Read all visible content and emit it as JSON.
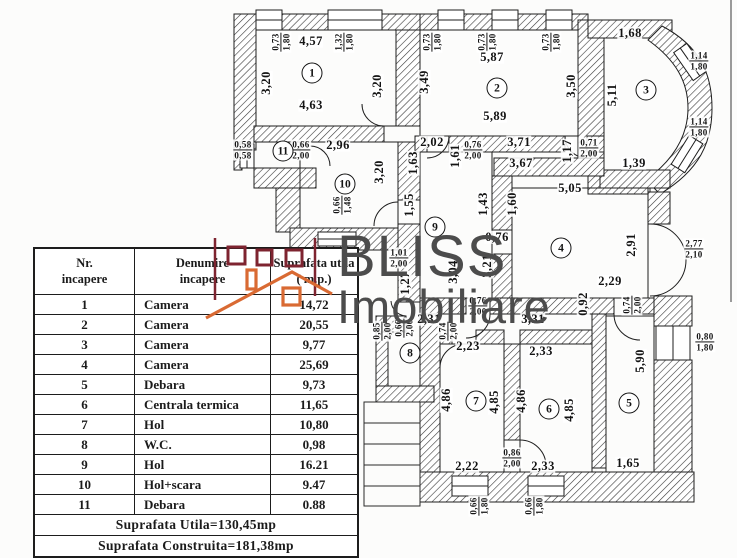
{
  "logo": {
    "line1": "BLISS",
    "line2": "Imobiliare"
  },
  "colors": {
    "brand_red": "#7e2430",
    "brand_orange": "#d96a33",
    "ink": "#1b1b1b",
    "logo_gray": "#4c4c4c"
  },
  "table": {
    "col1_header": "Nr.\nincapere",
    "col2_header": "Denumire\nincapere",
    "col3_header": "Suprafata utila\n( m.p.)",
    "rows": [
      {
        "nr": "1",
        "name": "Camera",
        "area": "14,72"
      },
      {
        "nr": "2",
        "name": "Camera",
        "area": "20,55"
      },
      {
        "nr": "3",
        "name": "Camera",
        "area": "9,77"
      },
      {
        "nr": "4",
        "name": "Camera",
        "area": "25,69"
      },
      {
        "nr": "5",
        "name": "Debara",
        "area": "9,73"
      },
      {
        "nr": "6",
        "name": "Centrala termica",
        "area": "11,65"
      },
      {
        "nr": "7",
        "name": "Hol",
        "area": "10,80"
      },
      {
        "nr": "8",
        "name": "W.C.",
        "area": "0,98"
      },
      {
        "nr": "9",
        "name": "Hol",
        "area": "16.21"
      },
      {
        "nr": "10",
        "name": "Hol+scara",
        "area": "9.47"
      },
      {
        "nr": "11",
        "name": "Debara",
        "area": "0.88"
      }
    ],
    "total_utila": "Suprafata Utila=130,45mp",
    "total_construita": "Suprafata Construita=181,38mp"
  },
  "plan": {
    "rooms": [
      {
        "n": "1",
        "x": 312,
        "y": 73
      },
      {
        "n": "2",
        "x": 497,
        "y": 88
      },
      {
        "n": "3",
        "x": 646,
        "y": 90
      },
      {
        "n": "4",
        "x": 561,
        "y": 248
      },
      {
        "n": "5",
        "x": 629,
        "y": 403
      },
      {
        "n": "6",
        "x": 549,
        "y": 409
      },
      {
        "n": "7",
        "x": 476,
        "y": 401
      },
      {
        "n": "8",
        "x": 410,
        "y": 353
      },
      {
        "n": "9",
        "x": 435,
        "y": 227
      },
      {
        "n": "10",
        "x": 345,
        "y": 184
      },
      {
        "n": "11",
        "x": 283,
        "y": 151
      }
    ],
    "labels": [
      {
        "t": "4,57",
        "x": 311,
        "y": 41
      },
      {
        "t": "0,73|1,80",
        "x": 281,
        "y": 42,
        "r": -90
      },
      {
        "t": "1,32|1,80",
        "x": 344,
        "y": 42,
        "r": -90
      },
      {
        "t": "3,20",
        "x": 266,
        "y": 83,
        "r": -90
      },
      {
        "t": "3,20",
        "x": 377,
        "y": 86,
        "r": -90
      },
      {
        "t": "4,63",
        "x": 311,
        "y": 105
      },
      {
        "t": "0,73|1,80",
        "x": 432,
        "y": 42,
        "r": -90
      },
      {
        "t": "0,73|1,80",
        "x": 487,
        "y": 42,
        "r": -90
      },
      {
        "t": "0,73|1,80",
        "x": 551,
        "y": 42,
        "r": -90
      },
      {
        "t": "5,87",
        "x": 492,
        "y": 57
      },
      {
        "t": "3,49",
        "x": 424,
        "y": 82,
        "r": -90
      },
      {
        "t": "3,50",
        "x": 571,
        "y": 86,
        "r": -90
      },
      {
        "t": "5,89",
        "x": 495,
        "y": 116
      },
      {
        "t": "1,68",
        "x": 630,
        "y": 33
      },
      {
        "t": "5,11",
        "x": 612,
        "y": 95,
        "r": -90
      },
      {
        "t": "1,14|1,80",
        "x": 699,
        "y": 61
      },
      {
        "t": "1,14|1,80",
        "x": 699,
        "y": 127
      },
      {
        "t": "1,39",
        "x": 634,
        "y": 163
      },
      {
        "t": "0,58|0,58",
        "x": 243,
        "y": 150
      },
      {
        "t": "0,66|2,00",
        "x": 301,
        "y": 150
      },
      {
        "t": "2,96",
        "x": 338,
        "y": 145
      },
      {
        "t": "3,20",
        "x": 379,
        "y": 172,
        "r": -90
      },
      {
        "t": "0,66|1,48",
        "x": 342,
        "y": 205,
        "r": -90
      },
      {
        "t": "1,63",
        "x": 413,
        "y": 163,
        "r": -90
      },
      {
        "t": "1,55",
        "x": 409,
        "y": 205,
        "r": -90
      },
      {
        "t": "2,02",
        "x": 432,
        "y": 142
      },
      {
        "t": "1,61",
        "x": 455,
        "y": 156,
        "r": -90
      },
      {
        "t": "0,76|2,00",
        "x": 473,
        "y": 150
      },
      {
        "t": "3,71",
        "x": 519,
        "y": 142
      },
      {
        "t": "3,67",
        "x": 521,
        "y": 163
      },
      {
        "t": "1,17",
        "x": 567,
        "y": 151,
        "r": -90
      },
      {
        "t": "0,71|2,00",
        "x": 589,
        "y": 148
      },
      {
        "t": "5,05",
        "x": 570,
        "y": 188
      },
      {
        "t": "1,43",
        "x": 483,
        "y": 204,
        "r": -90
      },
      {
        "t": "1,60",
        "x": 512,
        "y": 204,
        "r": -90
      },
      {
        "t": "0,76",
        "x": 497,
        "y": 237
      },
      {
        "t": "1,01|2,00",
        "x": 399,
        "y": 258
      },
      {
        "t": "1,27",
        "x": 405,
        "y": 283,
        "r": -90
      },
      {
        "t": "3,04",
        "x": 453,
        "y": 272,
        "r": -90
      },
      {
        "t": "3,21",
        "x": 487,
        "y": 266,
        "r": -90
      },
      {
        "t": "0,76|2,00",
        "x": 478,
        "y": 306
      },
      {
        "t": "2,91",
        "x": 631,
        "y": 245,
        "r": -90
      },
      {
        "t": "2,77|2,10",
        "x": 694,
        "y": 249
      },
      {
        "t": "2,29",
        "x": 610,
        "y": 281
      },
      {
        "t": "0,92",
        "x": 583,
        "y": 304,
        "r": -90
      },
      {
        "t": "2,31",
        "x": 429,
        "y": 319
      },
      {
        "t": "3,31",
        "x": 533,
        "y": 319
      },
      {
        "t": "0,74|2,00",
        "x": 448,
        "y": 331,
        "r": -90
      },
      {
        "t": "0,66|2,00",
        "x": 404,
        "y": 328,
        "r": -90
      },
      {
        "t": "0,85|2,00",
        "x": 382,
        "y": 331,
        "r": -90
      },
      {
        "t": "2,23",
        "x": 468,
        "y": 346
      },
      {
        "t": "4,86",
        "x": 446,
        "y": 400,
        "r": -90
      },
      {
        "t": "4,85",
        "x": 494,
        "y": 402,
        "r": -90
      },
      {
        "t": "2,22",
        "x": 467,
        "y": 466
      },
      {
        "t": "2,33",
        "x": 541,
        "y": 351
      },
      {
        "t": "4,86",
        "x": 521,
        "y": 401,
        "r": -90
      },
      {
        "t": "4,85",
        "x": 569,
        "y": 410,
        "r": -90
      },
      {
        "t": "0,86|2,00",
        "x": 512,
        "y": 458
      },
      {
        "t": "2,33",
        "x": 543,
        "y": 466
      },
      {
        "t": "0,74|2,00",
        "x": 632,
        "y": 305,
        "r": -90
      },
      {
        "t": "5,90",
        "x": 640,
        "y": 361,
        "r": -90
      },
      {
        "t": "1,65",
        "x": 628,
        "y": 463
      },
      {
        "t": "0,80|1,80",
        "x": 705,
        "y": 342
      },
      {
        "t": "0,66|1,80",
        "x": 479,
        "y": 506,
        "r": -90
      },
      {
        "t": "0,66|1,80",
        "x": 534,
        "y": 506,
        "r": -90
      }
    ]
  }
}
